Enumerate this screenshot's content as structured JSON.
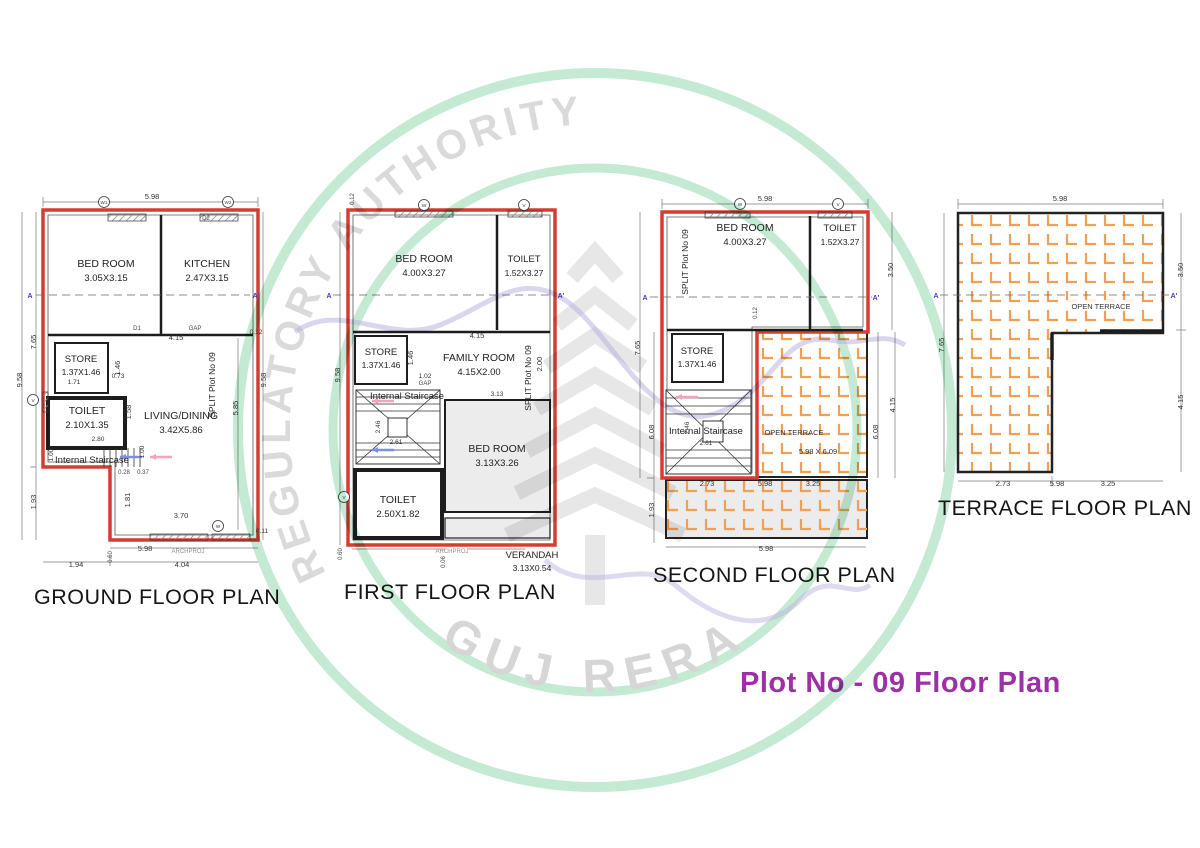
{
  "heading": "Plot No - 09 Floor Plan",
  "watermark": {
    "arc_text": "GUJARAT REAL ESTATE REGULATORY AUTHORITY",
    "bottom_text": "GUJ RERA",
    "green": "#bfe7cf",
    "gray": "#dadada"
  },
  "colors": {
    "boundary_red": "#d63c31",
    "tile_orange": "#f0a055",
    "heading_purple": "#9c31a5",
    "section_blue": "#3c3cc8"
  },
  "plans": {
    "ground": {
      "title": "GROUND FLOOR PLAN",
      "split_label": "SPLIT Plot No 09",
      "section": {
        "a": "A",
        "a2": "A'"
      },
      "tags": {
        "w1": "W1",
        "w2": "W2",
        "d2": "D2",
        "d1": "D1",
        "v": "V",
        "w": "W",
        "gap": "GAP"
      },
      "rooms": {
        "bed": {
          "name": "BED ROOM",
          "size": "3.05X3.15"
        },
        "kitchen": {
          "name": "KITCHEN",
          "size": "2.47X3.15"
        },
        "store": {
          "name": "STORE",
          "size": "1.37X1.46"
        },
        "toilet": {
          "name": "TOILET",
          "size": "2.10X1.35"
        },
        "living": {
          "name": "LIVING/DINING",
          "size": "3.42X5.86"
        },
        "stair": "Internal Staircase"
      },
      "dims": {
        "top": "5.98",
        "left_total": "9.58",
        "left_upper": "7.65",
        "left_lower": "1.93",
        "right_total": "9.58",
        "right_inner": "5.85",
        "right_top": "0.12",
        "right_bottom": "0.11",
        "w415": "4.15",
        "w146": "1.46",
        "w073": "0.73",
        "w171": "1.71",
        "w158": "1.58",
        "w280": "2.80",
        "w100a": "1.00",
        "w100b": "1.00",
        "w028": "0.28",
        "w037": "0.37",
        "w181": "1.81",
        "w370": "3.70",
        "bottom": "5.98",
        "archproj": "ARCHPROJ",
        "b060": "0.60",
        "b194": "1.94",
        "b404": "4.04"
      }
    },
    "first": {
      "title": "FIRST FLOOR PLAN",
      "split_label": "SPLIT Plot No 09",
      "section": {
        "a": "A",
        "a2": "A'"
      },
      "tags": {
        "w": "W",
        "v": "V",
        "v2": "V",
        "gap": "GAP"
      },
      "rooms": {
        "bed": {
          "name": "BED ROOM",
          "size": "4.00X3.27"
        },
        "toilet": {
          "name": "TOILET",
          "size": "1.52X3.27"
        },
        "store": {
          "name": "STORE",
          "size": "1.37X1.46"
        },
        "family": {
          "name": "FAMILY ROOM",
          "size": "4.15X2.00"
        },
        "bed2": {
          "name": "BED ROOM",
          "size": "3.13X3.26"
        },
        "toilet2": {
          "name": "TOILET",
          "size": "2.50X1.82"
        },
        "verandah": {
          "name": "VERANDAH",
          "size": "3.13X0.54"
        },
        "stair": "Internal Staircase"
      },
      "dims": {
        "top_left": "0.12",
        "left_total": "9.58",
        "w415": "4.15",
        "w146": "1.46",
        "w200": "2.00",
        "w102": "1.02",
        "w313": "3.13",
        "w246": "2.46",
        "w261": "2.61",
        "b060": "0.60",
        "archproj": "ARCHPROJ",
        "b006": "0.06"
      }
    },
    "second": {
      "title": "SECOND FLOOR PLAN",
      "split_label": "SPLIT Plot No 09",
      "section": {
        "a": "A",
        "a2": "A'"
      },
      "tags": {
        "w": "W",
        "v": "V"
      },
      "rooms": {
        "bed": {
          "name": "BED ROOM",
          "size": "4.00X3.27"
        },
        "toilet": {
          "name": "TOILET",
          "size": "1.52X3.27"
        },
        "store": {
          "name": "STORE",
          "size": "1.37X1.46"
        },
        "stair": "Internal Staircase",
        "terrace": {
          "name": "OPEN TERRACE",
          "size": "5.98 X 6.09"
        }
      },
      "dims": {
        "top": "5.98",
        "left_total": "7.65",
        "left_mid": "6.08",
        "left_lower": "1.93",
        "right_top": "3.50",
        "right_mid": "6.08",
        "right_outer": "4.15",
        "w012": "0.12",
        "w246": "2.46",
        "w261": "2.61",
        "b273": "2.73",
        "b598": "5.98",
        "b325": "3.25",
        "bottom": "5.98"
      }
    },
    "terrace": {
      "title": "TERRACE FLOOR PLAN",
      "section": {
        "a": "A",
        "a2": "A'"
      },
      "rooms": {
        "terrace": "OPEN TERRACE"
      },
      "dims": {
        "top": "5.98",
        "left": "7.65",
        "right_top": "3.50",
        "right_bottom": "4.15",
        "b273": "2.73",
        "b598": "5.98",
        "b325": "3.25"
      }
    }
  }
}
